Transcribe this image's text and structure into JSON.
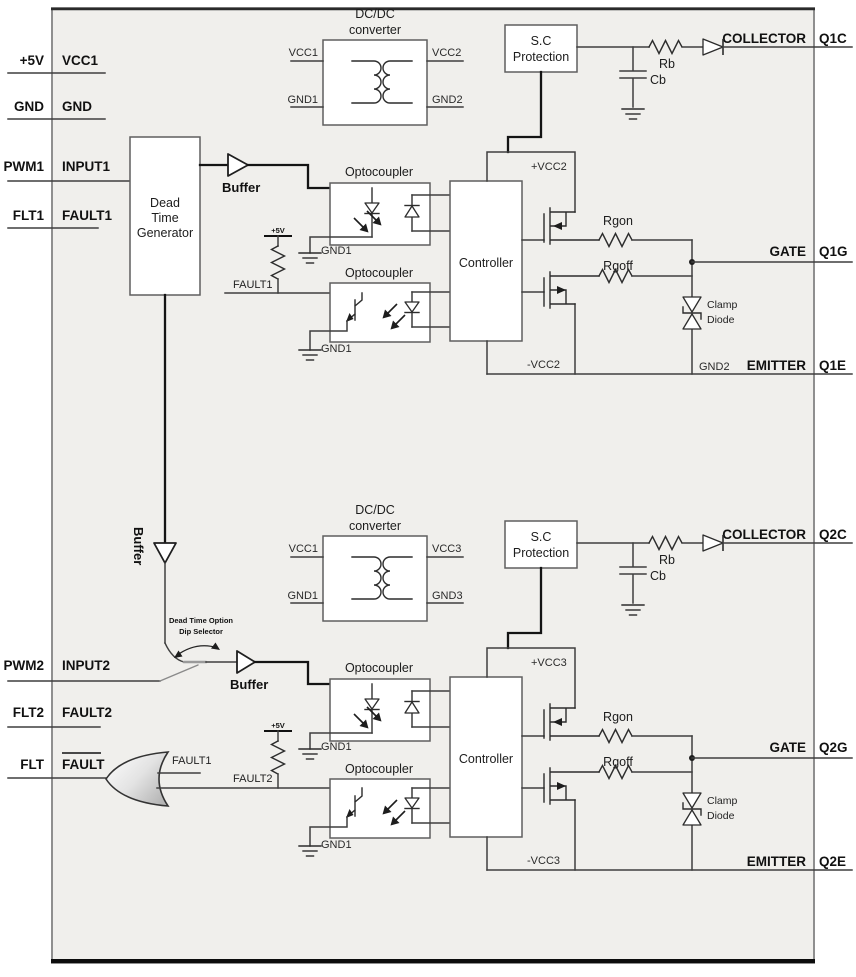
{
  "colors": {
    "panel": "#f0efec",
    "wire": "#3f3f3f",
    "thick_wire": "#141414",
    "switch_gray": "#9a9a9a"
  },
  "left_pins": [
    {
      "ext": "+5V",
      "int": "VCC1"
    },
    {
      "ext": "GND",
      "int": "GND"
    },
    {
      "ext": "PWM1",
      "int": "INPUT1"
    },
    {
      "ext": "FLT1",
      "int": "FAULT1"
    },
    {
      "ext": "PWM2",
      "int": "INPUT2"
    },
    {
      "ext": "FLT2",
      "int": "FAULT2"
    },
    {
      "ext": "FLT",
      "int": "FAULT"
    }
  ],
  "right_pins": [
    {
      "func": "COLLECTOR",
      "pin": "Q1C"
    },
    {
      "func": "GATE",
      "pin": "Q1G"
    },
    {
      "func": "EMITTER",
      "pin": "Q1E"
    },
    {
      "func": "COLLECTOR",
      "pin": "Q2C"
    },
    {
      "func": "GATE",
      "pin": "Q2G"
    },
    {
      "func": "EMITTER",
      "pin": "Q2E"
    }
  ],
  "ch1": {
    "dcdc": {
      "t1": "DC/DC",
      "t2": "converter",
      "tl": "VCC1",
      "bl": "GND1",
      "tr": "VCC2",
      "br": "GND2"
    },
    "sc": {
      "t1": "S.C",
      "t2": "Protection"
    },
    "buffer": "Buffer",
    "dtg": {
      "l1": "Dead",
      "l2": "Time",
      "l3": "Generator"
    },
    "opto1": {
      "title": "Optocoupler",
      "gnd": "GND1"
    },
    "opto2": {
      "title": "Optocoupler",
      "gnd": "GND1"
    },
    "rail": "+5V",
    "fault_net": "FAULT1",
    "controller": "Controller",
    "vcc_pos": "+VCC2",
    "vcc_neg": "-VCC2",
    "rgon": "Rgon",
    "rgoff": "Rgoff",
    "rb": "Rb",
    "cb": "Cb",
    "clamp": {
      "l1": "Clamp",
      "l2": "Diode"
    },
    "gnd2": "GND2"
  },
  "ch2": {
    "dcdc": {
      "t1": "DC/DC",
      "t2": "converter",
      "tl": "VCC1",
      "bl": "GND1",
      "tr": "VCC3",
      "br": "GND3"
    },
    "sc": {
      "t1": "S.C",
      "t2": "Protection"
    },
    "buffer": "Buffer",
    "opto1": {
      "title": "Optocoupler",
      "gnd": "GND1"
    },
    "opto2": {
      "title": "Optocoupler",
      "gnd": "GND1"
    },
    "rail": "+5V",
    "fault_net": "FAULT2",
    "controller": "Controller",
    "vcc_pos": "+VCC3",
    "vcc_neg": "-VCC3",
    "rgon": "Rgon",
    "rgoff": "Rgoff",
    "rb": "Rb",
    "cb": "Cb",
    "clamp": {
      "l1": "Clamp",
      "l2": "Diode"
    }
  },
  "mid": {
    "buffer_vertical": "Buffer",
    "dip1": "Dead Time Option",
    "dip2": "Dip Selector",
    "or_fault1": "FAULT1"
  }
}
